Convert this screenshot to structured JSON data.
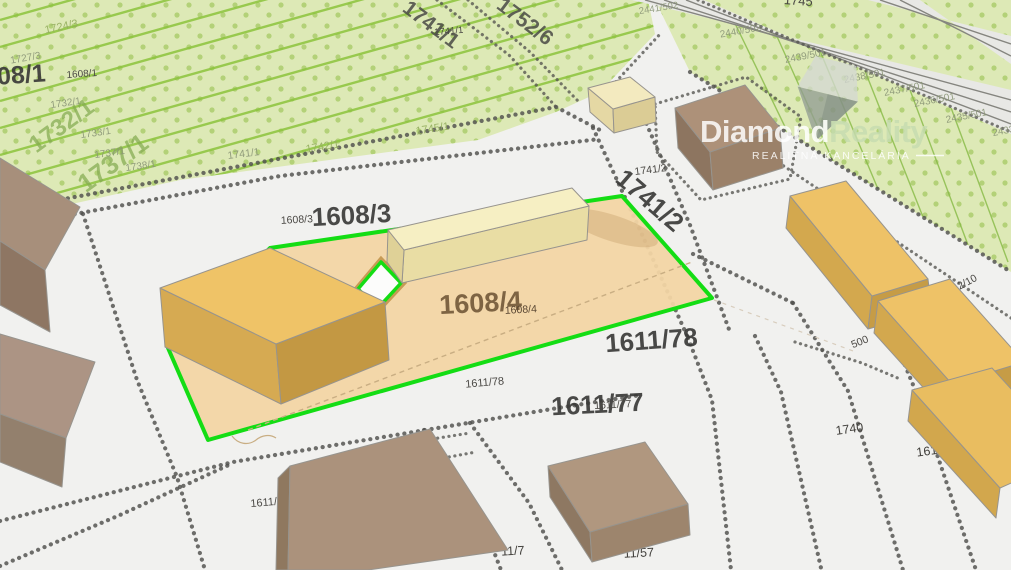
{
  "watermark": {
    "brand_part1": "Diamond",
    "brand_part2": "Reality",
    "tagline": "REALITNÁ KANCELÁRIA"
  },
  "colors": {
    "highlight_outline_green": "#14dd14",
    "highlight_parcel_fill": "#f2d5a4",
    "field_green": "#dde9b6",
    "field_stripe_green": "#8cc43d",
    "building_amber": "#efc367",
    "building_cream": "#f6efc3",
    "building_brown": "#ab927c",
    "background": "#f1f1ef"
  },
  "parcel_labels": [
    {
      "text": "1724/3",
      "x": 62,
      "y": 30,
      "size": 11,
      "rot": -12,
      "style": "sm-green"
    },
    {
      "text": "1727/3",
      "x": 26,
      "y": 61,
      "size": 10,
      "rot": -10,
      "style": "sm-grayg"
    },
    {
      "text": "1608/1",
      "x": 8,
      "y": 84,
      "size": 25,
      "rot": -4,
      "style": "xl-dark"
    },
    {
      "text": "1608/1",
      "x": 82,
      "y": 77,
      "size": 10,
      "rot": -4,
      "style": "sm-dark"
    },
    {
      "text": "1732/1",
      "x": 66,
      "y": 106,
      "size": 10,
      "rot": -8,
      "style": "sm-grayg"
    },
    {
      "text": "1732/1",
      "x": 66,
      "y": 132,
      "size": 24,
      "rot": -36,
      "style": "xl-green"
    },
    {
      "text": "1733/1",
      "x": 96,
      "y": 136,
      "size": 10,
      "rot": -8,
      "style": "sm-grayg"
    },
    {
      "text": "1737/1",
      "x": 118,
      "y": 170,
      "size": 26,
      "rot": -36,
      "style": "xl-green"
    },
    {
      "text": "1737/1",
      "x": 110,
      "y": 156,
      "size": 10,
      "rot": -8,
      "style": "sm-grayg"
    },
    {
      "text": "1738/1",
      "x": 141,
      "y": 169,
      "size": 10,
      "rot": -8,
      "style": "sm-grayg"
    },
    {
      "text": "1741/1",
      "x": 244,
      "y": 157,
      "size": 10.5,
      "rot": -7,
      "style": "sm-grayg"
    },
    {
      "text": "1742/1",
      "x": 323,
      "y": 150,
      "size": 11,
      "rot": -9,
      "style": "sm-green"
    },
    {
      "text": "1745/1",
      "x": 433,
      "y": 132,
      "size": 11,
      "rot": -9,
      "style": "sm-green"
    },
    {
      "text": "1741/1",
      "x": 427,
      "y": 30,
      "size": 21,
      "rot": 37,
      "style": "xl-dark2"
    },
    {
      "text": "1741/1",
      "x": 449,
      "y": 34,
      "size": 9.5,
      "rot": -5,
      "style": "sm-dark"
    },
    {
      "text": "1752/6",
      "x": 521,
      "y": 27,
      "size": 21,
      "rot": 37,
      "style": "xl-dark2"
    },
    {
      "text": "2441/502",
      "x": 659,
      "y": 11,
      "size": 9.5,
      "rot": -9,
      "style": "sm-grayg"
    },
    {
      "text": "1745",
      "x": 798,
      "y": 5,
      "size": 13,
      "rot": 4,
      "style": "sm-dark"
    },
    {
      "text": "2440/502",
      "x": 741,
      "y": 34,
      "size": 10,
      "rot": -10,
      "style": "sm-grayg"
    },
    {
      "text": "2439/501",
      "x": 806,
      "y": 59,
      "size": 10,
      "rot": -11,
      "style": "sm-grayg"
    },
    {
      "text": "2438/501",
      "x": 865,
      "y": 79,
      "size": 10,
      "rot": -11,
      "style": "sm-grayg"
    },
    {
      "text": "2437/501",
      "x": 905,
      "y": 92,
      "size": 10,
      "rot": -11,
      "style": "sm-grayg"
    },
    {
      "text": "2436/501",
      "x": 935,
      "y": 103,
      "size": 10,
      "rot": -11,
      "style": "sm-grayg"
    },
    {
      "text": "2435/501",
      "x": 967,
      "y": 119,
      "size": 10,
      "rot": -11,
      "style": "sm-grayg"
    },
    {
      "text": "2433",
      "x": 1004,
      "y": 134,
      "size": 10,
      "rot": -11,
      "style": "sm-grayg"
    },
    {
      "text": "1741/2",
      "x": 644,
      "y": 207,
      "size": 26,
      "rot": 41,
      "style": "xl-dark"
    },
    {
      "text": "1741/2",
      "x": 651,
      "y": 173,
      "size": 10.5,
      "rot": -7,
      "style": "sm-dark"
    },
    {
      "text": "1608/3",
      "x": 352,
      "y": 224,
      "size": 26,
      "rot": -3,
      "style": "xl-dark"
    },
    {
      "text": "1608/3",
      "x": 297,
      "y": 223,
      "size": 10.5,
      "rot": -3,
      "style": "sm-dark"
    },
    {
      "text": "1608/4",
      "x": 481,
      "y": 312,
      "size": 27,
      "rot": -3,
      "style": "xl-brown"
    },
    {
      "text": "1608/4",
      "x": 521,
      "y": 313,
      "size": 10.5,
      "rot": -3,
      "style": "sm-brown"
    },
    {
      "text": "1611/78",
      "x": 652,
      "y": 349,
      "size": 26,
      "rot": -4,
      "style": "xl-dark"
    },
    {
      "text": "1611/78",
      "x": 485,
      "y": 386,
      "size": 11,
      "rot": -5,
      "style": "sm-dark"
    },
    {
      "text": "1611/77",
      "x": 598,
      "y": 413,
      "size": 26,
      "rot": -3,
      "style": "xl-dark"
    },
    {
      "text": "1611/77",
      "x": 613,
      "y": 408,
      "size": 10.5,
      "rot": -3,
      "style": "sm-dark"
    },
    {
      "text": "1740",
      "x": 850,
      "y": 433,
      "size": 12.5,
      "rot": -8,
      "style": "md-dark"
    },
    {
      "text": "1618/4",
      "x": 936,
      "y": 454,
      "size": 12.5,
      "rot": -8,
      "style": "md-dark"
    },
    {
      "text": "500",
      "x": 861,
      "y": 345,
      "size": 10.5,
      "rot": -22,
      "style": "sm-dark"
    },
    {
      "text": "1642/10",
      "x": 961,
      "y": 289,
      "size": 10.5,
      "rot": -28,
      "style": "sm-dark"
    },
    {
      "text": "1741/2",
      "x": 869,
      "y": 297,
      "size": 9.5,
      "rot": -7,
      "style": "sm-dark"
    },
    {
      "text": "1611/",
      "x": 264,
      "y": 506,
      "size": 11,
      "rot": -5,
      "style": "sm-dark"
    },
    {
      "text": "11/7",
      "x": 513,
      "y": 555,
      "size": 12.5,
      "rot": -3,
      "style": "md-dark"
    },
    {
      "text": "11/57",
      "x": 639,
      "y": 557,
      "size": 12.5,
      "rot": -3,
      "style": "md-dark"
    }
  ]
}
